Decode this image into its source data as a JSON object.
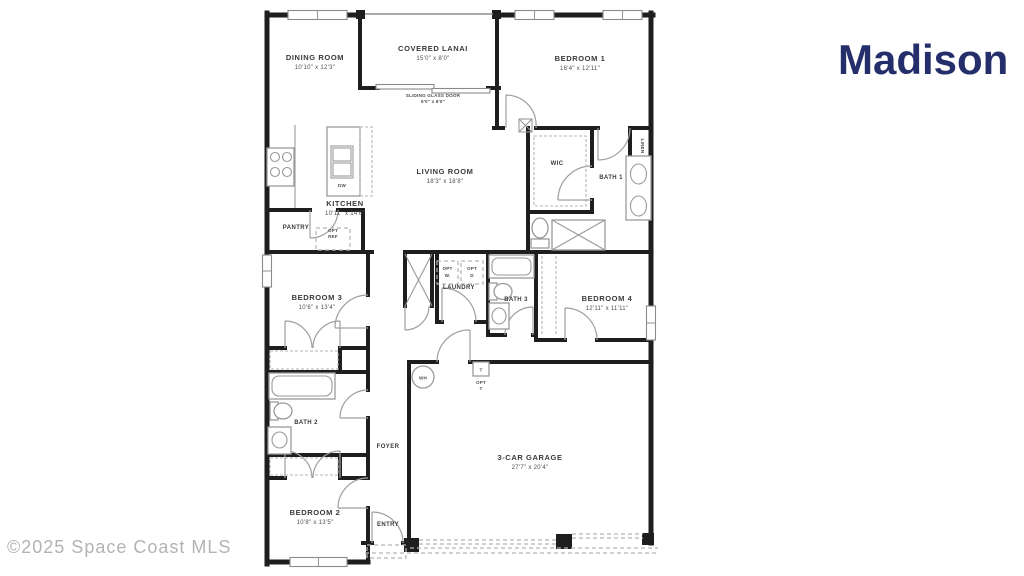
{
  "title": "Madison",
  "watermark": "©2025 Space Coast MLS",
  "colors": {
    "title_navy": "#242e6a",
    "walls": "#1e1e1e",
    "fixtures_gray": "#9a9a9a",
    "watermark_gray": "#b3b3b3"
  },
  "rooms": {
    "dining": {
      "name": "DINING ROOM",
      "dims": "10'10\" x 12'3\""
    },
    "lanai": {
      "name": "COVERED LANAI",
      "dims": "15'0\" x 8'0\""
    },
    "sgd": {
      "name": "SLIDING GLASS DOOR",
      "dims": "6'0\" x 8'0\""
    },
    "bedroom1": {
      "name": "BEDROOM 1",
      "dims": "16'4\" x 12'11\""
    },
    "living": {
      "name": "LIVING ROOM",
      "dims": "18'3\" x 18'8\""
    },
    "kitchen": {
      "name": "KITCHEN",
      "dims": "10'11\" x 14'6\""
    },
    "pantry": {
      "name": "PANTRY"
    },
    "wic": {
      "name": "WIC"
    },
    "bath1": {
      "name": "BATH 1"
    },
    "linen": {
      "name": "LINEN"
    },
    "bedroom3": {
      "name": "BEDROOM 3",
      "dims": "10'6\" x 13'4\""
    },
    "laundry": {
      "name": "LAUNDRY"
    },
    "bath3": {
      "name": "BATH 3"
    },
    "bedroom4": {
      "name": "BEDROOM 4",
      "dims": "12'11\" x 11'11\""
    },
    "bath2": {
      "name": "BATH 2"
    },
    "foyer": {
      "name": "FOYER"
    },
    "garage": {
      "name": "3-CAR GARAGE",
      "dims": "27'7\" x 20'4\""
    },
    "bedroom2": {
      "name": "BEDROOM 2",
      "dims": "10'8\" x 13'5\""
    },
    "entry": {
      "name": "ENTRY"
    }
  },
  "fixtures": {
    "dw": "DW",
    "wh": "WH",
    "opt_ref": {
      "l1": "OPT",
      "l2": "REF"
    },
    "opt_w": {
      "l1": "OPT",
      "l2": "W."
    },
    "opt_d": {
      "l1": "OPT",
      "l2": "D"
    },
    "tank": {
      "box": "T",
      "l1": "OPT",
      "l2": "T"
    }
  }
}
